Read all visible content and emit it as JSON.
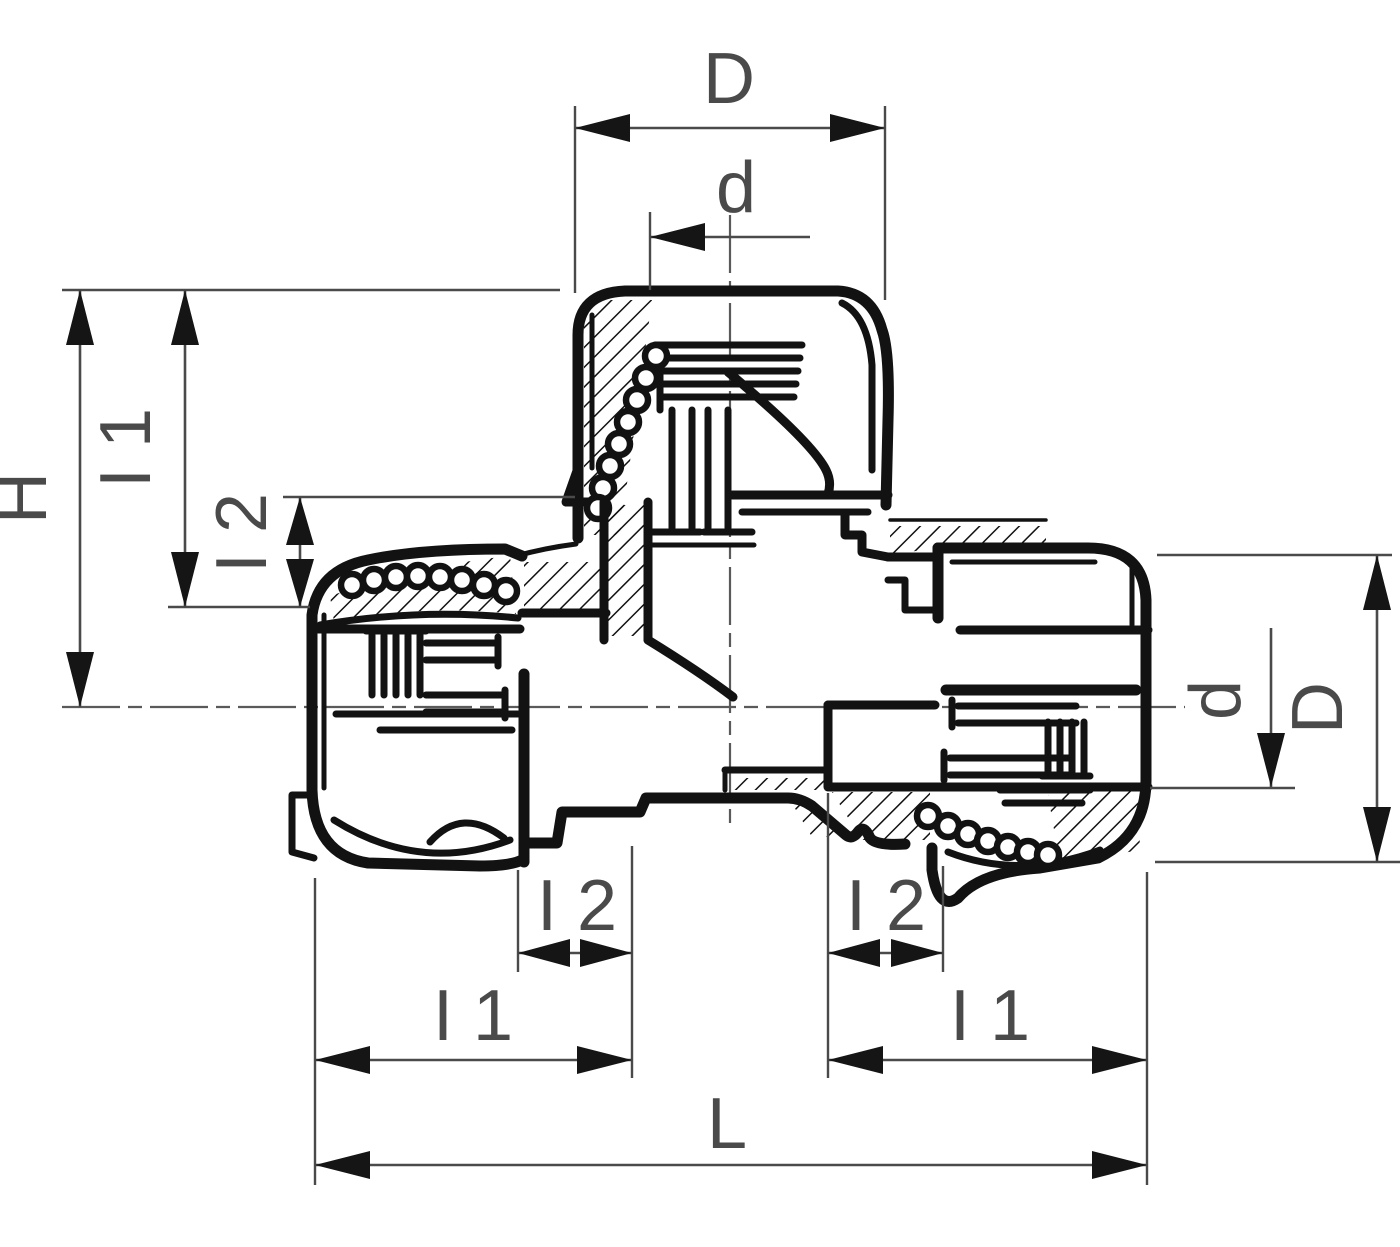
{
  "drawing": {
    "type": "technical-dimension-drawing",
    "subject": "tee compression pipe fitting, half-section view",
    "background_color": "#ffffff",
    "line_color": "#121212",
    "dimension_color": "#4a4a4a",
    "labels": {
      "top_outer_width": "D",
      "top_bore_diameter": "d",
      "overall_height": "H",
      "left_vertical_l1": "I 1",
      "left_vertical_l2": "I 2",
      "bottom_left_l2": "I 2",
      "bottom_left_l1": "I 1",
      "bottom_right_l2": "I 2",
      "bottom_right_l1": "I 1",
      "overall_length": "L",
      "right_bore_diameter": "d",
      "right_outer_diameter": "D"
    }
  }
}
